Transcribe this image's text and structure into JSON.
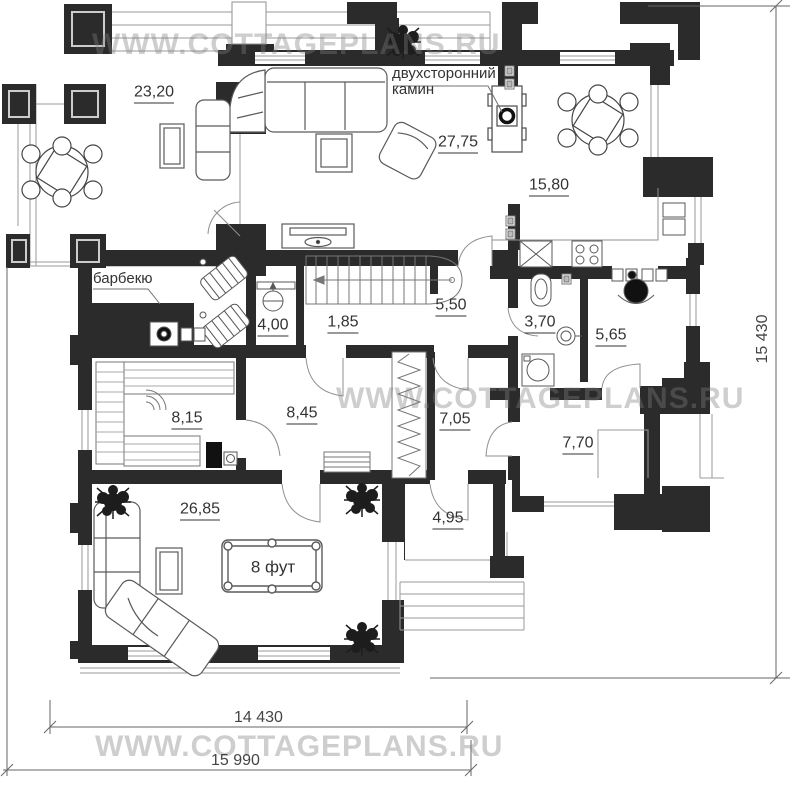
{
  "watermark": {
    "text": "WWW.COTTAGEPLANS.RU"
  },
  "annotations": {
    "fireplace_line1": "двухсторонний",
    "fireplace_line2": "камин",
    "barbecue": "барбекю",
    "pool_table": "8 фут"
  },
  "rooms": [
    {
      "name": "terrace",
      "area": "23,20"
    },
    {
      "name": "living",
      "area": "27,75"
    },
    {
      "name": "dining",
      "area": "15,80"
    },
    {
      "name": "room-4-00",
      "area": "4,00"
    },
    {
      "name": "stair-hall",
      "area": "1,85"
    },
    {
      "name": "corridor",
      "area": "5,50"
    },
    {
      "name": "bathroom",
      "area": "3,70"
    },
    {
      "name": "study",
      "area": "5,65"
    },
    {
      "name": "sauna",
      "area": "8,15"
    },
    {
      "name": "hall",
      "area": "8,45"
    },
    {
      "name": "room-7-05",
      "area": "7,05"
    },
    {
      "name": "entry",
      "area": "7,70"
    },
    {
      "name": "billiard",
      "area": "26,85"
    },
    {
      "name": "porch",
      "area": "4,95"
    }
  ],
  "dimensions": {
    "right": "15 430",
    "bottom_inner": "14 430",
    "bottom_outer": "15 990"
  },
  "colors": {
    "wall": "#2b2b2b",
    "thin_line": "#8f8f8f",
    "furniture": "#555555",
    "watermark": "#bdbdbd",
    "text": "#333333"
  }
}
